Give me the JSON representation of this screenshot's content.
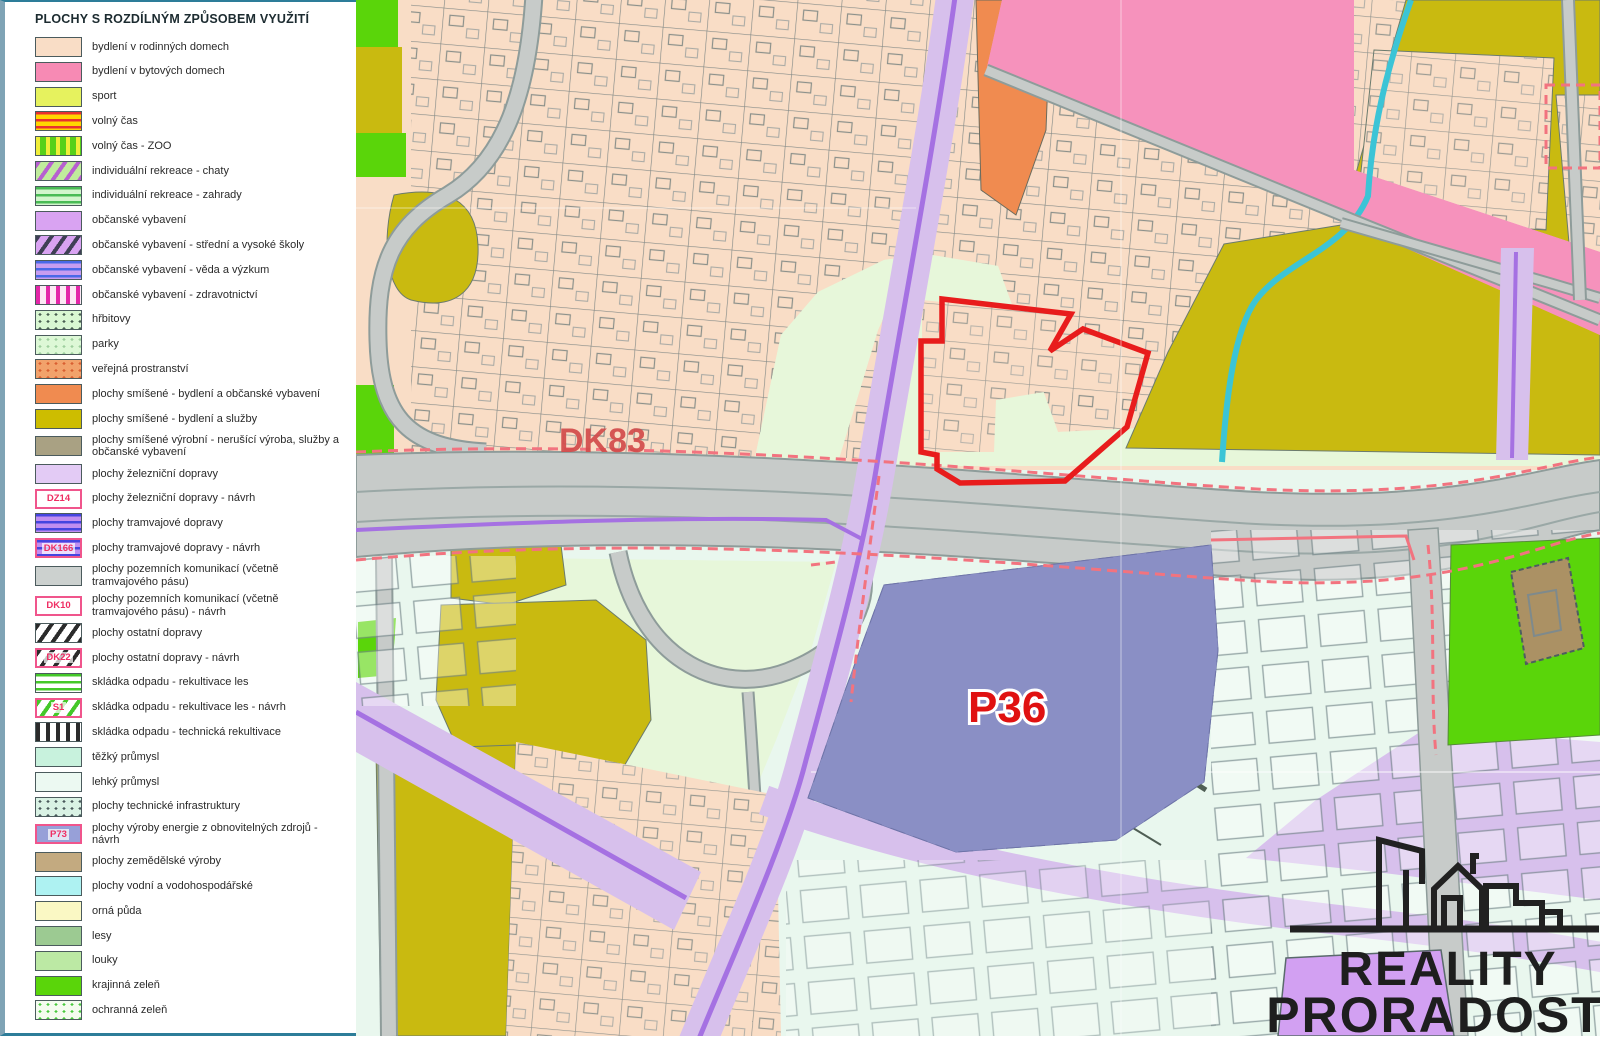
{
  "legend": {
    "title": "PLOCHY S ROZDÍLNÝM ZPŮSOBEM VYUŽITÍ",
    "items": [
      {
        "label": "bydlení v rodinných domech",
        "swatch": {
          "type": "solid",
          "bg": "#f9ddc6"
        }
      },
      {
        "label": "bydlení v bytových domech",
        "swatch": {
          "type": "solid",
          "bg": "#f78ab4"
        }
      },
      {
        "label": "sport",
        "swatch": {
          "type": "solid",
          "bg": "#e6f25e"
        }
      },
      {
        "label": "volný čas",
        "swatch": {
          "type": "hstripes",
          "bg": "#ffd500",
          "fg": "#e83030"
        }
      },
      {
        "label": "volný čas - ZOO",
        "swatch": {
          "type": "vstripes",
          "bg": "#57d019",
          "fg": "#f0ee3a"
        }
      },
      {
        "label": "individuální rekreace - chaty",
        "swatch": {
          "type": "diag",
          "bg": "#c0ec9c",
          "fg": "#b75fd0"
        }
      },
      {
        "label": "individuální rekreace - zahrady",
        "swatch": {
          "type": "hstripes",
          "bg": "#d2f5cc",
          "fg": "#49bb55"
        }
      },
      {
        "label": "občanské vybavení",
        "swatch": {
          "type": "solid",
          "bg": "#d9a3f2"
        }
      },
      {
        "label": "občanské vybavení - střední a vysoké školy",
        "swatch": {
          "type": "diag",
          "bg": "#d9a3f2",
          "fg": "#3f3f55"
        }
      },
      {
        "label": "občanské vybavení - věda a výzkum",
        "swatch": {
          "type": "hstripes",
          "bg": "#c79df0",
          "fg": "#4969e8"
        }
      },
      {
        "label": "občanské vybavení  - zdravotnictví",
        "swatch": {
          "type": "vstripes",
          "bg": "#fce8f4",
          "fg": "#e327a8"
        }
      },
      {
        "label": "hřbitovy",
        "swatch": {
          "type": "dots",
          "bg": "#d9f7d2",
          "fg": "#4a6052"
        }
      },
      {
        "label": "parky",
        "swatch": {
          "type": "dots",
          "bg": "#ddf8d6",
          "fg": "#9ecf9e"
        }
      },
      {
        "label": "veřejná prostranství",
        "swatch": {
          "type": "dots",
          "bg": "#f2a26b",
          "fg": "#d95f31"
        }
      },
      {
        "label": "plochy smíšené - bydlení a občanské vybavení",
        "swatch": {
          "type": "solid",
          "bg": "#f08b50"
        }
      },
      {
        "label": "plochy smíšené - bydlení a služby",
        "swatch": {
          "type": "solid",
          "bg": "#cdbd00"
        }
      },
      {
        "label": "plochy smíšené výrobní - nerušící výroba, služby a občanské vybavení",
        "swatch": {
          "type": "solid",
          "bg": "#a9a183"
        }
      },
      {
        "label": "plochy železniční dopravy",
        "swatch": {
          "type": "solid",
          "bg": "#e3cbf5"
        }
      },
      {
        "label": "plochy železniční dopravy - návrh",
        "badge": "DZ14",
        "swatch": {
          "type": "solid",
          "bg": "#ffffff"
        }
      },
      {
        "label": "plochy tramvajové dopravy",
        "swatch": {
          "type": "hstripes",
          "bg": "#c18ef0",
          "fg": "#4545e0"
        }
      },
      {
        "label": "plochy tramvajové dopravy - návrh",
        "badge": "DK166",
        "swatch": {
          "type": "hstripes",
          "bg": "#c18ef0",
          "fg": "#4545e0"
        }
      },
      {
        "label": "plochy pozemních komunikací (včetně tramvajového pásu)",
        "swatch": {
          "type": "solid",
          "bg": "#ccd1cf"
        }
      },
      {
        "label": "plochy pozemních komunikací (včetně tramvajového pásu) - návrh",
        "badge": "DK10",
        "swatch": {
          "type": "solid",
          "bg": "#ffffff"
        }
      },
      {
        "label": "plochy ostatní dopravy",
        "swatch": {
          "type": "diag",
          "bg": "#ffffff",
          "fg": "#2b2b2b"
        }
      },
      {
        "label": "plochy ostatní dopravy - návrh",
        "badge": "DK22",
        "swatch": {
          "type": "diag",
          "bg": "#ffffff",
          "fg": "#2b2b2b"
        }
      },
      {
        "label": "skládka odpadu - rekultivace les",
        "swatch": {
          "type": "hstripes",
          "bg": "#ffffff",
          "fg": "#44c829"
        }
      },
      {
        "label": "skládka odpadu - rekultivace les - návrh",
        "badge": "S1",
        "swatch": {
          "type": "diag",
          "bg": "#ffffff",
          "fg": "#44c829"
        }
      },
      {
        "label": "skládka odpadu - technická rekultivace",
        "swatch": {
          "type": "vstripes",
          "bg": "#ffffff",
          "fg": "#2b2b2b"
        }
      },
      {
        "label": "těžký průmysl",
        "swatch": {
          "type": "solid",
          "bg": "#c8f2dd"
        }
      },
      {
        "label": "lehký průmysl",
        "swatch": {
          "type": "solid",
          "bg": "#ecf9f2"
        }
      },
      {
        "label": "plochy technické infrastruktury",
        "swatch": {
          "type": "dots",
          "bg": "#d9f2e4",
          "fg": "#4a5a5c"
        }
      },
      {
        "label": "plochy výroby energie z obnovitelných zdrojů - návrh",
        "badge": "P73",
        "swatch": {
          "type": "solid",
          "bg": "#97a0d8"
        }
      },
      {
        "label": "plochy zemědělské výroby",
        "swatch": {
          "type": "solid",
          "bg": "#c3aa80"
        }
      },
      {
        "label": "plochy vodní a vodohospodářské",
        "swatch": {
          "type": "solid",
          "bg": "#aef2f2"
        }
      },
      {
        "label": "orná půda",
        "swatch": {
          "type": "solid",
          "bg": "#faf8c4"
        }
      },
      {
        "label": "lesy",
        "swatch": {
          "type": "solid",
          "bg": "#9cca92"
        }
      },
      {
        "label": "louky",
        "swatch": {
          "type": "solid",
          "bg": "#bce9a4"
        }
      },
      {
        "label": "krajinná zeleň",
        "swatch": {
          "type": "solid",
          "bg": "#5ad50a"
        }
      },
      {
        "label": "ochranná zeleň",
        "swatch": {
          "type": "dots",
          "bg": "#f4fbef",
          "fg": "#49c93e"
        }
      }
    ]
  },
  "map": {
    "labels": {
      "dk83": "DK83",
      "p36": "P36"
    },
    "colors": {
      "family_housing": "#f9ddc6",
      "flat_housing": "#f692bc",
      "mixed_services": "#c9ba10",
      "mixed_civic": "#f08b50",
      "energy_area": "#8a8fc5",
      "railway": "#d7c0ec",
      "tram_line": "#a571e2",
      "light_industry": "#e9f7ee",
      "protective_green_bg": "#e7f7da",
      "protective_green_dot": "#2fae3c",
      "landscape_green": "#5ad50a",
      "road": "#c7cbc9",
      "water": "#3cc4d6",
      "agriculture": "#ab9164",
      "highlight_red": "#e81f28",
      "proposal_boundary_pink": "#f2737f",
      "label_red": "#e01111"
    }
  },
  "logo": {
    "line1": "REALITY",
    "line2": "PRORADOST"
  }
}
